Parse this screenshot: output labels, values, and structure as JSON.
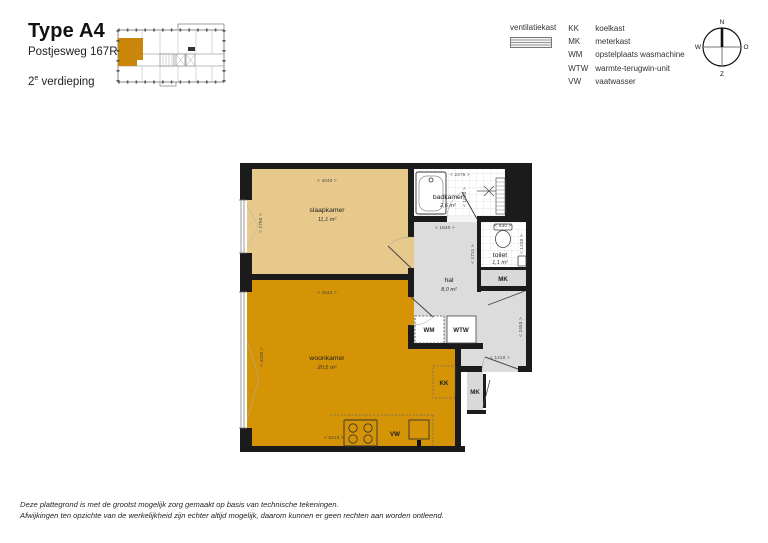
{
  "header": {
    "title": "Type A4",
    "address": "Postjesweg 167R",
    "floor_number": "2",
    "floor_ordinal_suffix": "e",
    "floor_word": "verdieping"
  },
  "legend": {
    "ventilatiekast": "ventilatiekast",
    "items": [
      {
        "abbr": "KK",
        "desc": "koelkast"
      },
      {
        "abbr": "MK",
        "desc": "meterkast"
      },
      {
        "abbr": "WM",
        "desc": "opstelplaats wasmachine"
      },
      {
        "abbr": "WTW",
        "desc": "warmte-terugwin-unit"
      },
      {
        "abbr": "VW",
        "desc": "vaatwasser"
      }
    ]
  },
  "compass": {
    "north": "N",
    "east": "O",
    "south": "Z",
    "west": "W"
  },
  "plan": {
    "rooms": {
      "slaapkamer": {
        "name": "slaapkamer",
        "area": "11,1 m²"
      },
      "woonkamer": {
        "name": "woonkamer",
        "area": "20,5 m²"
      },
      "badkamer": {
        "name": "badkamer",
        "area": "2,6 m²"
      },
      "toilet": {
        "name": "toilet",
        "area": "1,1 m²"
      },
      "hal": {
        "name": "hal",
        "area": "8,0 m²"
      }
    },
    "appliances": {
      "wm": "WM",
      "wtw": "WTW",
      "kk": "KK",
      "vw": "VW",
      "mk_hal": "MK",
      "mk_gallery": "MK"
    },
    "dimensions": {
      "slaapkamer_width": "< 4040 >",
      "slaapkamer_depth": "< 2760 >",
      "badkamer_width": "< 2475 >",
      "badkamer_inner": "< 1060 >",
      "hal_width": "< 1840 >",
      "toilet_width": "< 930 >",
      "toilet_depth": "< 1230 >",
      "toilet_mk_depth": "< 1711 >",
      "woonkamer_width": "< 4040 >",
      "woonkamer_depth": "< 4435 >",
      "hal_depth": "< 2453 >",
      "entrance_width": "< 1210 >",
      "kitchen_width": "< 5215 >"
    }
  },
  "footer": {
    "line1": "Deze plattegrond is met de grootst mogelijk zorg gemaakt op basis van technische tekeningen.",
    "line2": "Afwijkingen ten opzichte van de werkelijkheid zijn echter altijd mogelijk, daarom kunnen er geen rechten aan worden ontleend."
  },
  "colors": {
    "unit_orange": "#d59405",
    "bedroom_tan": "#e8c98c",
    "hall_gray": "#dcdcdc",
    "wall_black": "#1b1b1b",
    "map_highlight": "#c8860b"
  }
}
